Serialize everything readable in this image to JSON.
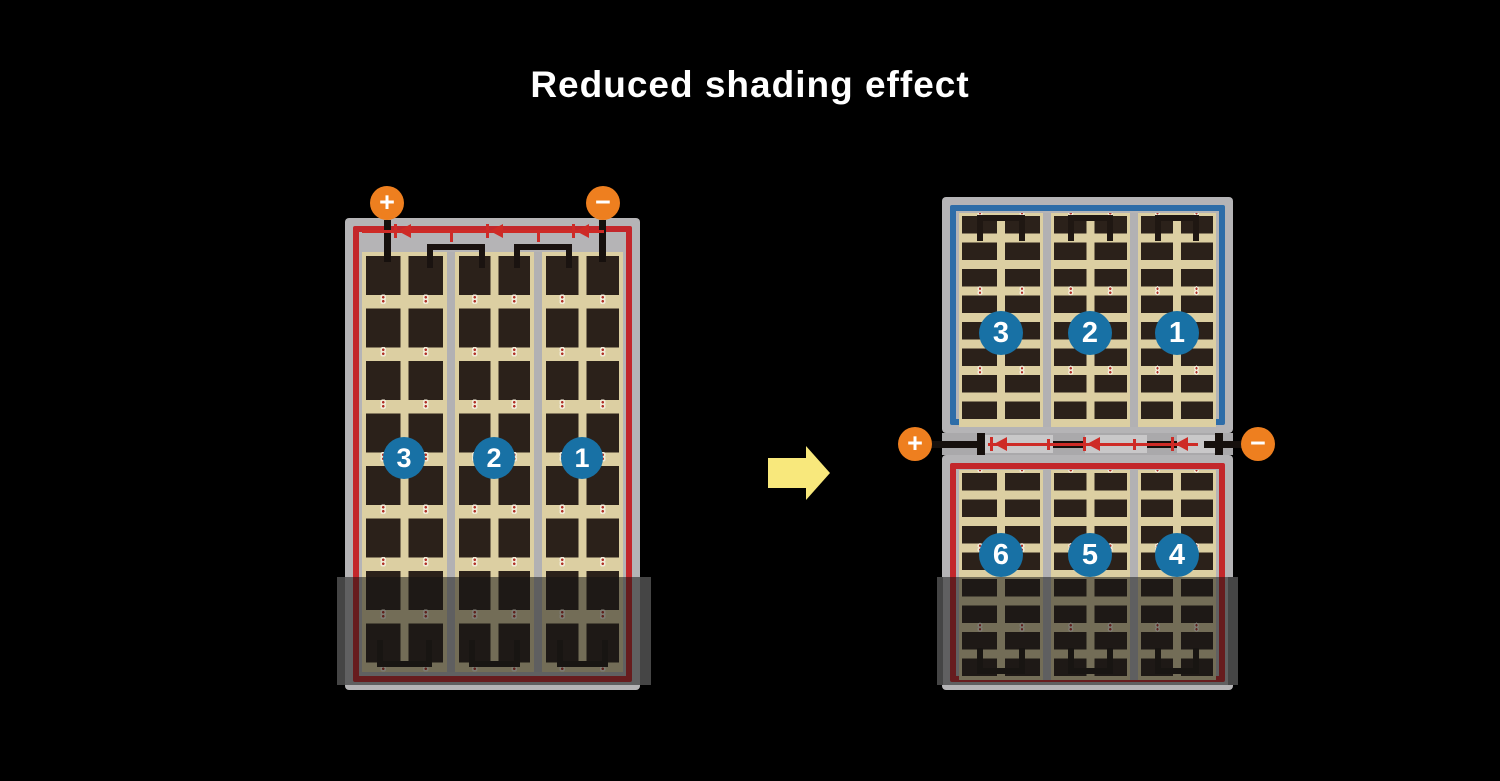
{
  "title": "Reduced shading effect",
  "before_panel": {
    "description": "full-cell module",
    "terminals": {
      "plus": "+",
      "minus": "−"
    },
    "string_labels": [
      "3",
      "2",
      "1"
    ]
  },
  "after_module": {
    "description": "half-cut module, split into top and bottom halves",
    "top_half": {
      "string_labels": [
        "3",
        "2",
        "1"
      ]
    },
    "bottom_half": {
      "string_labels": [
        "6",
        "5",
        "4"
      ]
    },
    "terminals": {
      "plus": "+",
      "minus": "−"
    }
  },
  "colors": {
    "background": "#000000",
    "title_text": "#FFFFFF",
    "frame_gray": "#B5B4B6",
    "cell_background_tan": "#DCCFA2",
    "cell_dark": "#2B211A",
    "border_red": "#C3272B",
    "border_blue": "#2E6DA8",
    "wire_red": "#CE2B26",
    "terminal_orange": "#EE7F1F",
    "number_circle_blue": "#1871A5",
    "arrow_yellow": "#F8E87C"
  }
}
